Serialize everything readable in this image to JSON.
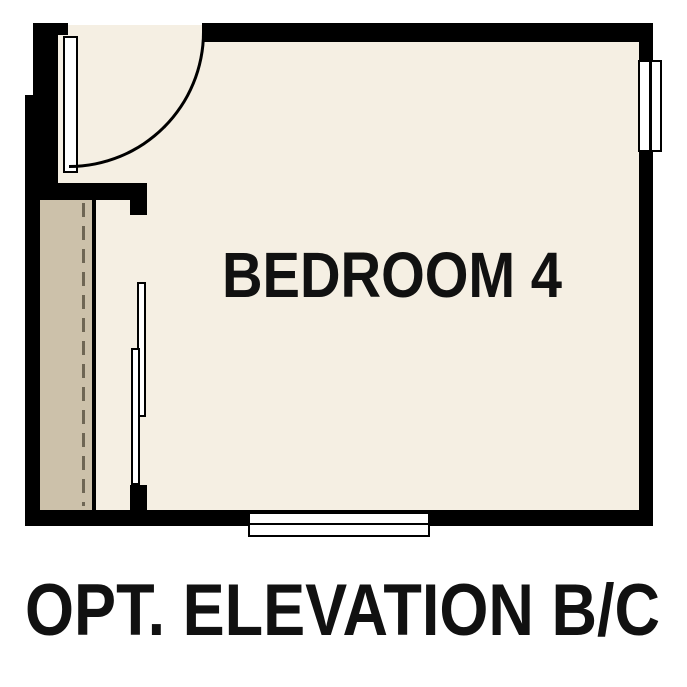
{
  "colors": {
    "background": "#ffffff",
    "wall": "#000000",
    "floor": "#f5efe3",
    "closet_floor": "#ccc1aa",
    "dash_line": "#6e6654",
    "symbol_fill": "#ffffff",
    "label_text": "#111111"
  },
  "plan": {
    "room_label": "BEDROOM 4",
    "caption": "OPT. ELEVATION B/C",
    "elements": {
      "door": "hinged-door-swing-arc",
      "closet_doors": "bypass-sliding-doors",
      "window_right": "window-symbol",
      "window_bottom": "window-symbol",
      "closet_line": "dashed-closet-line"
    }
  }
}
